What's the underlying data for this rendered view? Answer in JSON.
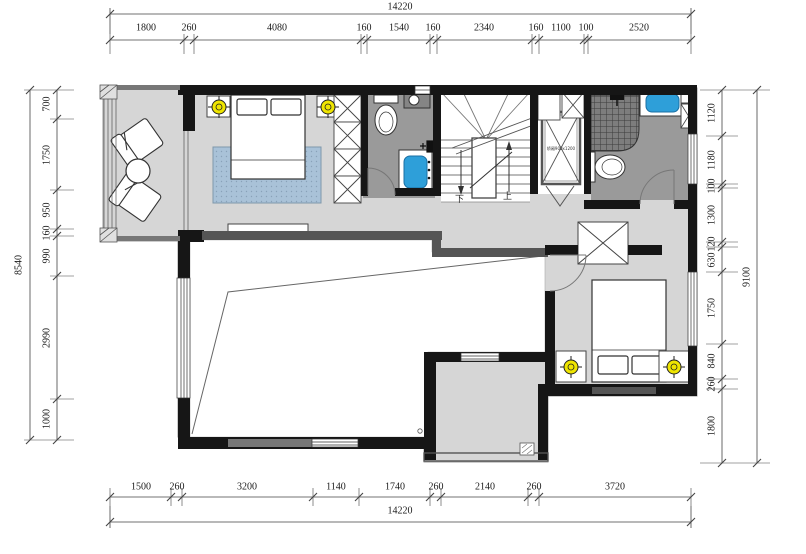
{
  "title": "floor-plan",
  "dims": {
    "top": {
      "overall": "14220",
      "segments": [
        "1800",
        "260",
        "4080",
        "160",
        "1540",
        "160",
        "2340",
        "160",
        "1100",
        "100",
        "2520"
      ]
    },
    "bottom": {
      "overall": "14220",
      "segments": [
        "1500",
        "260",
        "3200",
        "1140",
        "1740",
        "260",
        "2140",
        "260",
        "3720"
      ]
    },
    "left": {
      "overall": "8540",
      "segments": [
        "700",
        "1750",
        "950",
        "160",
        "990",
        "2990",
        "1000"
      ]
    },
    "right": {
      "overall": "9100",
      "segments": [
        "1120",
        "1180",
        "100",
        "1300",
        "120",
        "630",
        "1750",
        "840",
        "260",
        "1800"
      ]
    }
  },
  "labels": {
    "stairs_down": "下",
    "stairs_up": "上",
    "elevator": "轿厢900x1200"
  },
  "colors": {
    "wall": "#161616",
    "secondary_wall": "#555555",
    "floor": "#d6d6d6",
    "wet_floor": "#9a9a9a",
    "rug": "#a9c2d8",
    "fixture_blue": "#2e9fd9",
    "light_yellow": "#efe500"
  }
}
